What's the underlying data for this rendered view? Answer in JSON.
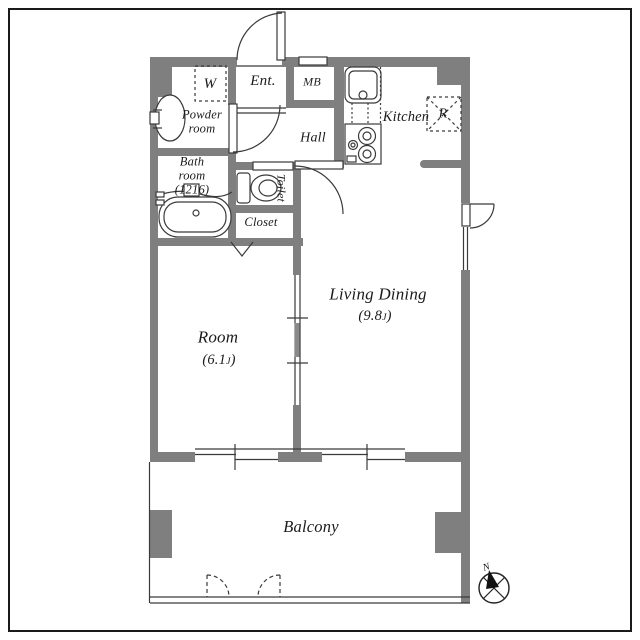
{
  "floorplan": {
    "rooms": {
      "entrance": "Ent.",
      "meter_box": "MB",
      "hall": "Hall",
      "kitchen": "Kitchen",
      "refrigerator": "R",
      "washer": "W",
      "powder_line1": "Powder",
      "powder_line2": "room",
      "bath_line1": "Bath",
      "bath_line2": "room",
      "bath_line3": "(1216)",
      "toilet": "Toilet",
      "closet": "Closet",
      "room_name": "Room",
      "room_size_pre": "(6.1",
      "room_size_unit": "J",
      "room_size_post": ")",
      "living_name": "Living Dining",
      "living_size_pre": "(9.8",
      "living_size_unit": "J",
      "living_size_post": ")",
      "balcony": "Balcony"
    },
    "compass_north": "N",
    "colors": {
      "wall": "#7f7f7f",
      "line": "#3a3a3a",
      "background": "#ffffff",
      "frame": "#1a1a1a"
    }
  }
}
